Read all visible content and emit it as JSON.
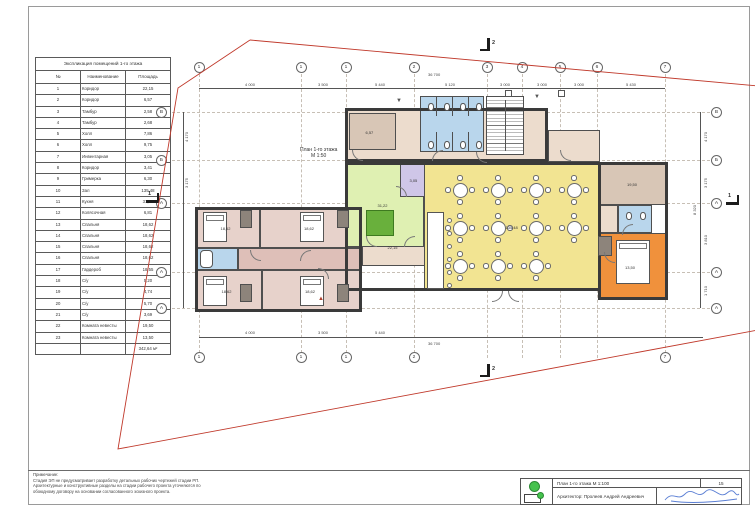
{
  "explication": {
    "title": "Экспликация помещений 1-го этажа",
    "columns": [
      "№",
      "Наименование",
      "Площадь"
    ],
    "rows": [
      [
        "1",
        "Коридор",
        "22,15"
      ],
      [
        "2",
        "Коридор",
        "6,57"
      ],
      [
        "3",
        "Тамбур",
        "2,58"
      ],
      [
        "4",
        "Тамбур",
        "2,68"
      ],
      [
        "5",
        "Холл",
        "7,86"
      ],
      [
        "6",
        "Холл",
        "9,75"
      ],
      [
        "7",
        "Инвентарная",
        "3,05"
      ],
      [
        "8",
        "Коридор",
        "3,41"
      ],
      [
        "9",
        "Гримерка",
        "6,30"
      ],
      [
        "10",
        "Зал",
        "135,48"
      ],
      [
        "11",
        "Кухня",
        "31,22"
      ],
      [
        "12",
        "Колясочная",
        "6,81"
      ],
      [
        "13",
        "Спальня",
        "18,62"
      ],
      [
        "14",
        "Спальня",
        "18,62"
      ],
      [
        "15",
        "Спальня",
        "18,62"
      ],
      [
        "16",
        "Спальня",
        "18,62"
      ],
      [
        "17",
        "Гардероб",
        "18,55"
      ],
      [
        "18",
        "С/у",
        "5,20"
      ],
      [
        "19",
        "С/у",
        "4,74"
      ],
      [
        "20",
        "С/у",
        "5,70"
      ],
      [
        "21",
        "С/у",
        "3,69"
      ],
      [
        "22",
        "Комната невесты",
        "19,50"
      ],
      [
        "23",
        "Комната невесты",
        "13,50"
      ]
    ],
    "total": "342,64 м²"
  },
  "plan": {
    "label_line1": "План 1-го этажа",
    "label_line2": "М 1:50",
    "axes_top": [
      {
        "t": "1",
        "x": 199
      },
      {
        "t": "1",
        "x": 301
      },
      {
        "t": "1",
        "x": 346
      },
      {
        "t": "2",
        "x": 414
      },
      {
        "t": "3",
        "x": 487
      },
      {
        "t": "4",
        "x": 522
      },
      {
        "t": "5",
        "x": 560
      },
      {
        "t": "6",
        "x": 597
      },
      {
        "t": "7",
        "x": 665
      }
    ],
    "axes_bottom": [
      {
        "t": "1",
        "x": 199
      },
      {
        "t": "1",
        "x": 301
      },
      {
        "t": "1",
        "x": 346
      },
      {
        "t": "2",
        "x": 414
      },
      {
        "t": "7",
        "x": 665
      }
    ],
    "letters_left": [
      {
        "t": "В",
        "y": 112
      },
      {
        "t": "Б",
        "y": 160
      },
      {
        "t": "А",
        "y": 203
      },
      {
        "t": "А",
        "y": 272
      },
      {
        "t": "А",
        "y": 308
      }
    ],
    "letters_right": [
      {
        "t": "В",
        "y": 112
      },
      {
        "t": "Б",
        "y": 160
      },
      {
        "t": "А",
        "y": 203
      },
      {
        "t": "А",
        "y": 272
      },
      {
        "t": "А",
        "y": 308
      }
    ],
    "dim_labels": [
      {
        "t": "36 700",
        "x": 428,
        "y": 72,
        "rot": false
      },
      {
        "t": "4 000",
        "x": 245,
        "y": 82,
        "rot": false
      },
      {
        "t": "3 500",
        "x": 318,
        "y": 82,
        "rot": false
      },
      {
        "t": "5 440",
        "x": 375,
        "y": 82,
        "rot": false
      },
      {
        "t": "5 120",
        "x": 445,
        "y": 82,
        "rot": false
      },
      {
        "t": "3 000",
        "x": 500,
        "y": 82,
        "rot": false
      },
      {
        "t": "3 000",
        "x": 537,
        "y": 82,
        "rot": false
      },
      {
        "t": "3 000",
        "x": 574,
        "y": 82,
        "rot": false
      },
      {
        "t": "5 430",
        "x": 626,
        "y": 82,
        "rot": false
      },
      {
        "t": "4 000",
        "x": 245,
        "y": 330,
        "rot": false
      },
      {
        "t": "3 500",
        "x": 318,
        "y": 330,
        "rot": false
      },
      {
        "t": "5 440",
        "x": 375,
        "y": 330,
        "rot": false
      },
      {
        "t": "36 700",
        "x": 428,
        "y": 341,
        "rot": false
      },
      {
        "t": "4 170",
        "x": 703,
        "y": 142,
        "rot": true
      },
      {
        "t": "3 175",
        "x": 703,
        "y": 188,
        "rot": true
      },
      {
        "t": "3 810",
        "x": 703,
        "y": 245,
        "rot": true
      },
      {
        "t": "1 710",
        "x": 703,
        "y": 296,
        "rot": true
      },
      {
        "t": "8 320",
        "x": 692,
        "y": 215,
        "rot": true
      },
      {
        "t": "4 170",
        "x": 184,
        "y": 142,
        "rot": true
      },
      {
        "t": "3 175",
        "x": 184,
        "y": 188,
        "rot": true
      }
    ],
    "rooms": [
      {
        "n": "bedroom-1",
        "x": 195,
        "y": 207,
        "w": 65,
        "h": 41,
        "f": "pink",
        "label": "18,62"
      },
      {
        "n": "bedroom-2",
        "x": 260,
        "y": 207,
        "w": 102,
        "h": 41,
        "f": "pink",
        "label": "18,62"
      },
      {
        "n": "bathroom-left",
        "x": 197,
        "y": 248,
        "w": 41,
        "h": 22,
        "f": "blue",
        "label": ""
      },
      {
        "n": "wing-corridor",
        "x": 238,
        "y": 248,
        "w": 124,
        "h": 22,
        "f": "pink2",
        "label": ""
      },
      {
        "n": "bedroom-3",
        "x": 195,
        "y": 270,
        "w": 67,
        "h": 42,
        "f": "pink",
        "label": "18,62"
      },
      {
        "n": "bedroom-4",
        "x": 262,
        "y": 270,
        "w": 100,
        "h": 42,
        "f": "pink",
        "label": "18,62"
      },
      {
        "n": "connector-corridor",
        "x": 362,
        "y": 228,
        "w": 65,
        "h": 38,
        "f": "beige",
        "label": "22,15"
      },
      {
        "n": "top-landing",
        "x": 345,
        "y": 108,
        "w": 203,
        "h": 54,
        "f": "beige",
        "label": ""
      },
      {
        "n": "dressing-room",
        "x": 349,
        "y": 113,
        "w": 47,
        "h": 37,
        "f": "tan",
        "label": "6,57"
      },
      {
        "n": "wc-block",
        "x": 420,
        "y": 96,
        "w": 64,
        "h": 56,
        "f": "blue",
        "label": ""
      },
      {
        "n": "top-strip-right",
        "x": 548,
        "y": 130,
        "w": 52,
        "h": 32,
        "f": "beige",
        "label": ""
      },
      {
        "n": "kitchen",
        "x": 345,
        "y": 162,
        "w": 79,
        "h": 85,
        "f": "green",
        "label": "31,22"
      },
      {
        "n": "inventory-room",
        "x": 400,
        "y": 162,
        "w": 33,
        "h": 35,
        "f": "purple",
        "label": "3,05"
      },
      {
        "n": "hall",
        "x": 424,
        "y": 162,
        "w": 177,
        "h": 129,
        "f": "yellow",
        "label": "135,48"
      },
      {
        "n": "bride-room-1",
        "x": 600,
        "y": 162,
        "w": 68,
        "h": 43,
        "f": "tan",
        "label": "19,50"
      },
      {
        "n": "corridor-right",
        "x": 600,
        "y": 205,
        "w": 18,
        "h": 28,
        "f": "beige",
        "label": ""
      },
      {
        "n": "wc-right",
        "x": 618,
        "y": 205,
        "w": 34,
        "h": 28,
        "f": "blue",
        "label": ""
      },
      {
        "n": "bride-room-2",
        "x": 598,
        "y": 233,
        "w": 68,
        "h": 67,
        "f": "orange",
        "label": "13,50"
      }
    ],
    "outlines": [
      {
        "x": 195,
        "y": 207,
        "w": 167,
        "h": 105
      },
      {
        "x": 345,
        "y": 108,
        "w": 203,
        "h": 54
      },
      {
        "x": 345,
        "y": 162,
        "w": 256,
        "h": 129
      },
      {
        "x": 598,
        "y": 162,
        "w": 70,
        "h": 138
      }
    ],
    "stairs": {
      "x": 486,
      "y": 96,
      "w": 38,
      "h": 59
    },
    "bar": {
      "x": 427,
      "y": 212,
      "w": 17,
      "h": 77
    },
    "beds": [
      {
        "x": 203,
        "y": 212,
        "w": 24,
        "h": 30
      },
      {
        "x": 300,
        "y": 212,
        "w": 24,
        "h": 30
      },
      {
        "x": 203,
        "y": 276,
        "w": 24,
        "h": 30
      },
      {
        "x": 300,
        "y": 276,
        "w": 24,
        "h": 30
      },
      {
        "x": 616,
        "y": 240,
        "w": 34,
        "h": 44
      }
    ],
    "wardrobes": [
      {
        "x": 240,
        "y": 210,
        "w": 12,
        "h": 18
      },
      {
        "x": 337,
        "y": 210,
        "w": 12,
        "h": 18
      },
      {
        "x": 240,
        "y": 284,
        "w": 12,
        "h": 18
      },
      {
        "x": 337,
        "y": 284,
        "w": 12,
        "h": 18
      },
      {
        "x": 598,
        "y": 236,
        "w": 14,
        "h": 20
      }
    ],
    "tables": [
      [
        460,
        190
      ],
      [
        498,
        190
      ],
      [
        536,
        190
      ],
      [
        574,
        190
      ],
      [
        460,
        228
      ],
      [
        498,
        228
      ],
      [
        536,
        228
      ],
      [
        574,
        228
      ],
      [
        460,
        266
      ],
      [
        498,
        266
      ],
      [
        536,
        266
      ]
    ],
    "stools": [
      [
        447,
        218
      ],
      [
        447,
        231
      ],
      [
        447,
        244
      ],
      [
        447,
        257
      ],
      [
        447,
        270
      ],
      [
        447,
        283
      ]
    ],
    "toilets": [
      [
        428,
        103
      ],
      [
        444,
        103
      ],
      [
        460,
        103
      ],
      [
        476,
        103
      ],
      [
        428,
        141
      ],
      [
        444,
        141
      ],
      [
        460,
        141
      ],
      [
        476,
        141
      ],
      [
        626,
        212
      ],
      [
        640,
        212
      ]
    ],
    "tub": {
      "x": 200,
      "y": 250,
      "w": 13,
      "h": 18
    },
    "green_table": {
      "x": 366,
      "y": 210,
      "w": 28,
      "h": 26
    },
    "doors": [
      {
        "x": 366,
        "y": 236,
        "r": 0
      },
      {
        "x": 404,
        "y": 236,
        "r": 90
      },
      {
        "x": 492,
        "y": 291,
        "r": 270
      },
      {
        "x": 508,
        "y": 291,
        "r": 0
      },
      {
        "x": 396,
        "y": 186,
        "r": 180
      },
      {
        "x": 432,
        "y": 150,
        "r": 90
      },
      {
        "x": 352,
        "y": 150,
        "r": 0
      },
      {
        "x": 560,
        "y": 150,
        "r": 0
      },
      {
        "x": 250,
        "y": 250,
        "r": 0
      },
      {
        "x": 300,
        "y": 250,
        "r": 90
      },
      {
        "x": 318,
        "y": 268,
        "r": 180
      },
      {
        "x": 604,
        "y": 252,
        "r": 0
      },
      {
        "x": 622,
        "y": 224,
        "r": 90
      },
      {
        "x": 476,
        "y": 152,
        "r": 0
      }
    ],
    "triangles": [
      {
        "t": "▼",
        "x": 396,
        "y": 98,
        "c": "#555"
      },
      {
        "t": "▼",
        "x": 534,
        "y": 94,
        "c": "#555"
      },
      {
        "t": "▲",
        "x": 318,
        "y": 296,
        "c": "#b0412f"
      }
    ],
    "squares": [
      [
        505,
        90
      ],
      [
        558,
        90
      ]
    ],
    "section_markers": [
      {
        "t": "2",
        "x": 487,
        "y": 38,
        "o": "v"
      },
      {
        "t": "2",
        "x": 487,
        "y": 364,
        "o": "v"
      },
      {
        "t": "1",
        "x": 146,
        "y": 200,
        "o": "h"
      },
      {
        "t": "1",
        "x": 726,
        "y": 202,
        "o": "h"
      }
    ]
  },
  "notes": {
    "heading": "Примечание:",
    "lines": [
      "Стадия ЭП не предусматривает разработку детальных рабочих чертежей стадии РП.",
      "Архитектурные и конструктивные разделы на стадии рабочего проекта уточняются по",
      "обоюдному договору на основании согласованного эскизного проекта."
    ]
  },
  "titleblock": {
    "drawing_title": "План 1-го этажа М 1:100",
    "sheet_number": "15",
    "architect": "Архитектор: Пролеев Андрей Андреевич",
    "logo": "green-circle-logo",
    "signature": "handwritten-signature"
  },
  "colors": {
    "boundary_red": "#c0392b",
    "wall_dark": "#3a3a3a",
    "hall_yellow": "#f2e492",
    "kitchen_green": "#dff0b2",
    "bedroom_pink": "#e7d2cb",
    "corridor_pink": "#debfb8",
    "wet_blue": "#b9d6ec",
    "room_tan": "#d8c6b6",
    "landing_beige": "#ecdccd",
    "inventory_purple": "#cfc6e8",
    "bride_orange": "#f0913c",
    "logo_green": "#45c24d",
    "signature_blue": "#5b7fd4"
  }
}
